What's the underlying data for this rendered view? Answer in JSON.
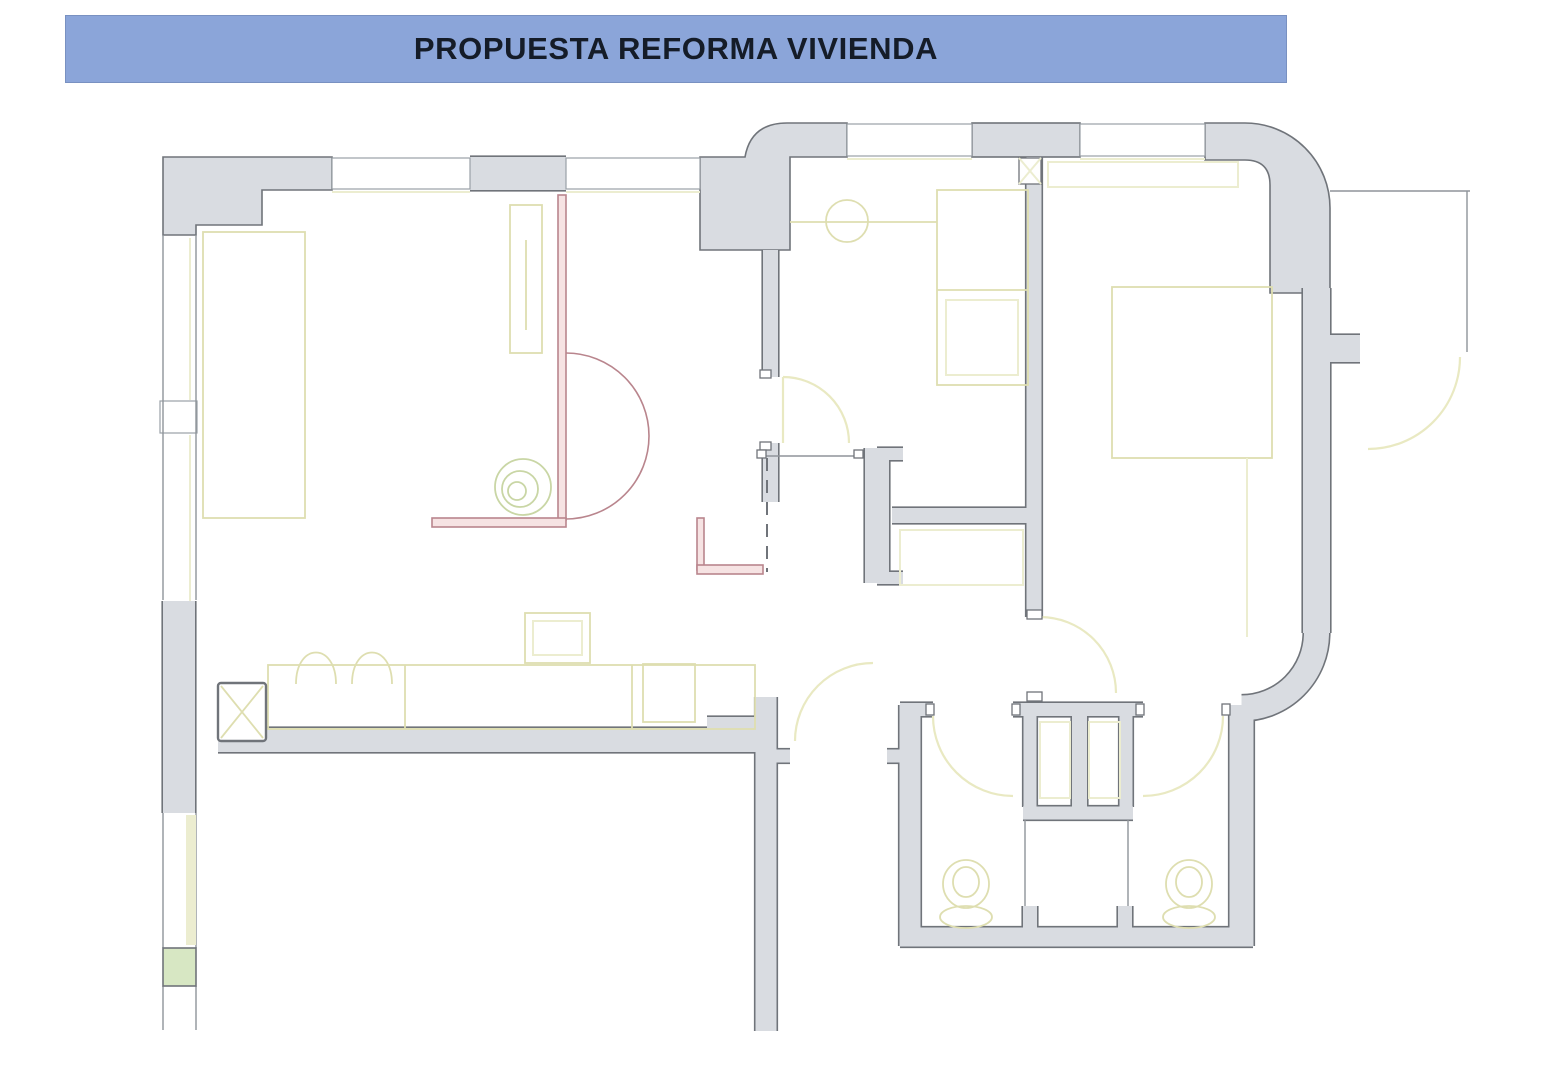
{
  "title_bar": {
    "text": "PROPUESTA REFORMA VIVIENDA"
  },
  "palette": {
    "page_bg": "#ffffff",
    "title_bg": "#8ba5d9",
    "title_text": "#151c28",
    "wall_fill": "#d9dce1",
    "wall_outline": "#70747a",
    "window_line": "#9aa0a6",
    "thin_line": "#8f949a",
    "furniture": "#dedeb0",
    "furniture_soft": "#ecedd0",
    "door_arc": "#e9e9c2",
    "reform_red": "#b9858d",
    "reform_red_fill": "#f6e3e3",
    "green_line": "#c9d6a5",
    "green_fill": "#d7e7c3"
  },
  "plan": {
    "type": "floor-plan",
    "room_labels_visible": false,
    "elements": [
      "walls",
      "windows",
      "doors",
      "wardrobe",
      "kitchen-counter",
      "hob-burners",
      "structural-column",
      "ventilation-duct",
      "bed",
      "closets",
      "washer-counter",
      "shower-trays",
      "toilet",
      "toilet",
      "reform-partitions",
      "plant-circles"
    ]
  }
}
